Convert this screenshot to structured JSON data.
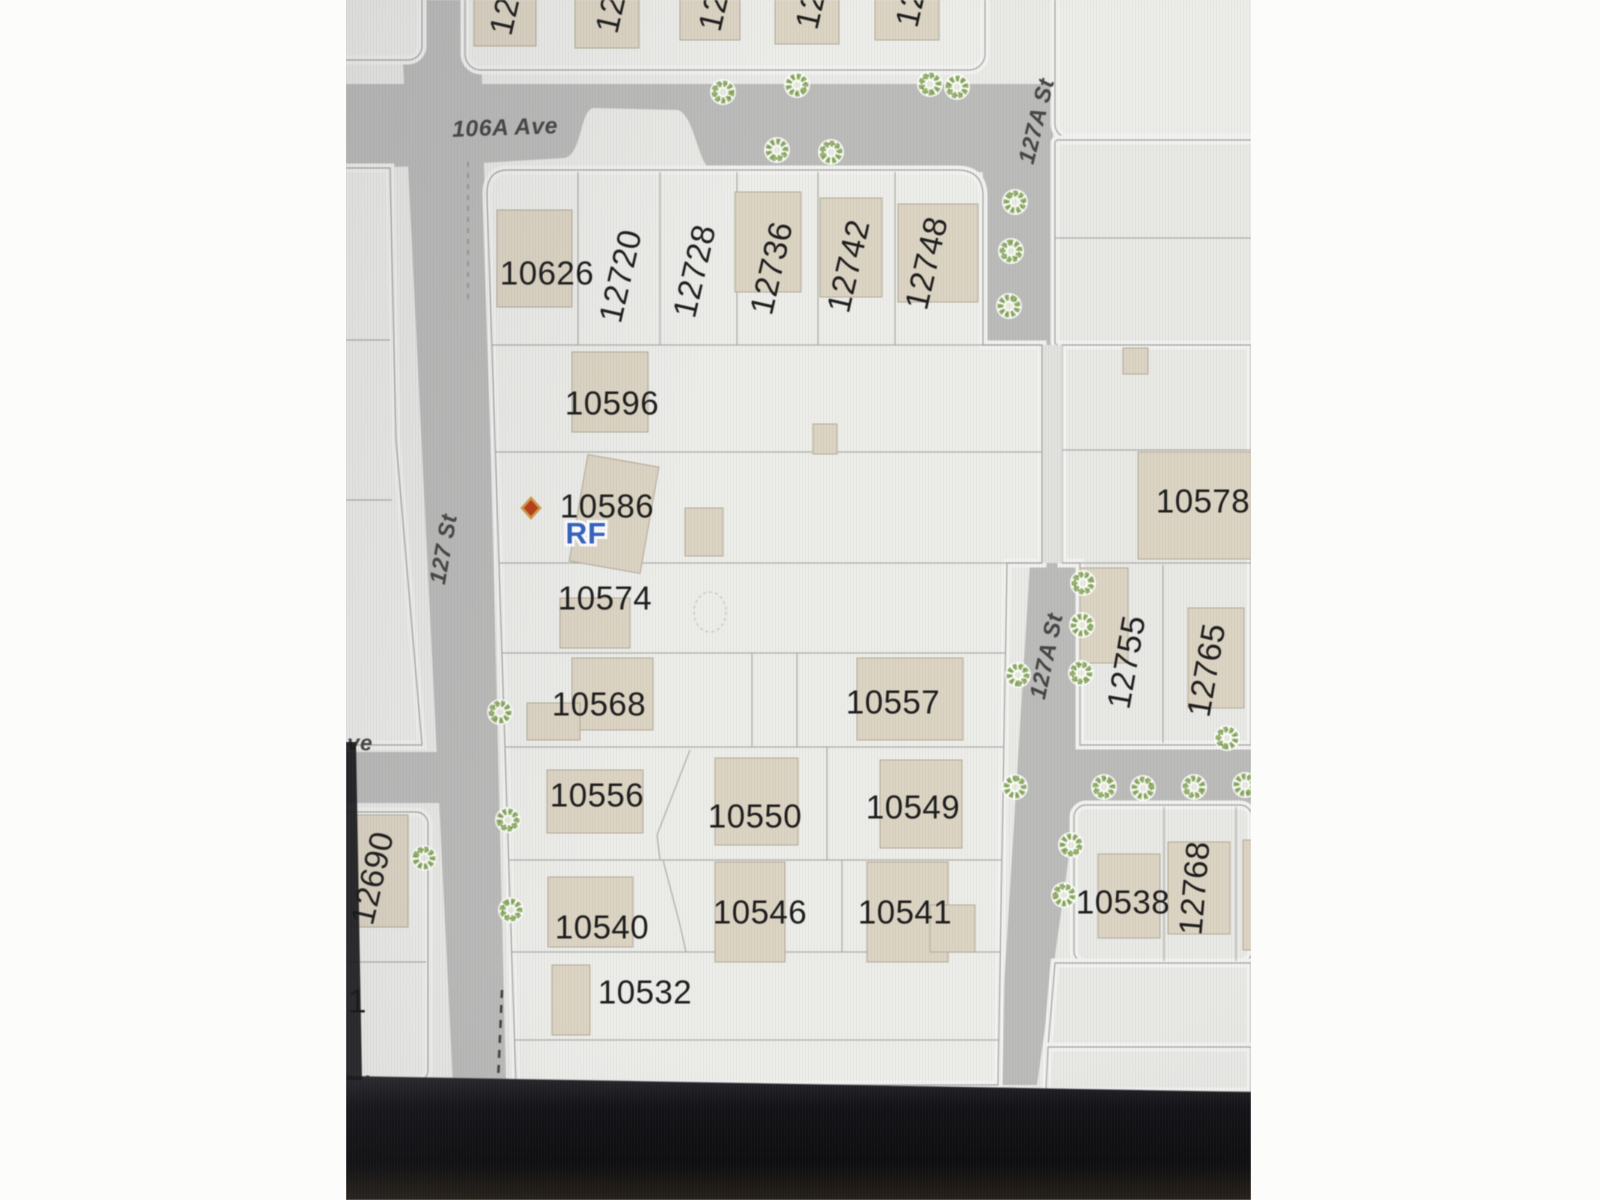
{
  "scene": {
    "description": "photo of a computer screen showing a cadastral parcel map",
    "bezel": {
      "top_left_y": 1076,
      "top_right_y": 1092,
      "left_strip": "M0,742 L10,742 L16,1080 L0,1080 Z"
    }
  },
  "colors": {
    "pillar": "#fcfcfb",
    "parcel": "#eaeae7",
    "block": "#ededea",
    "block_east": "#e9e9e6",
    "lane": "#e2e2df",
    "road": "#bcbcbb",
    "line": "#a7a7a5",
    "halo": "#f3f3f1",
    "building": "#ded5c2",
    "building_stroke": "#b7ae97",
    "label": "#1b1b1b",
    "street": "#454543",
    "tree_ring": "#93b264",
    "tree_dark": "#75974a",
    "tree_core": "#e7ecdb",
    "rf_blue": "#2e62c8",
    "marker_red": "#c23b10",
    "marker_halo": "#d79a43",
    "bezel_a": "#26262b",
    "bezel_b": "#121216",
    "bezel_c": "#0c0c0e",
    "bezel_d": "#241e16"
  },
  "map": {
    "streets": [
      {
        "label": "106A Ave",
        "x": 159,
        "y": 127,
        "rot": -2,
        "size": 23
      },
      {
        "label": "127 St",
        "x": 97,
        "y": 549,
        "rot": -80,
        "size": 23
      },
      {
        "label": "127A St",
        "x": 690,
        "y": 121,
        "rot": -76,
        "size": 23
      },
      {
        "label": "127A St",
        "x": 700,
        "y": 656,
        "rot": -78,
        "size": 23
      },
      {
        "label": "ve",
        "x": 14,
        "y": 743,
        "rot": 0,
        "size": 22
      }
    ],
    "lots": [
      {
        "label": "10626",
        "x": 201,
        "y": 273
      },
      {
        "label": "12720",
        "x": 274,
        "y": 276,
        "rot": -77
      },
      {
        "label": "12728",
        "x": 348,
        "y": 271,
        "rot": -77
      },
      {
        "label": "12736",
        "x": 425,
        "y": 268,
        "rot": -77
      },
      {
        "label": "12742",
        "x": 502,
        "y": 266,
        "rot": -77
      },
      {
        "label": "12748",
        "x": 580,
        "y": 263,
        "rot": -77
      },
      {
        "label": "10596",
        "x": 266,
        "y": 403
      },
      {
        "label": "10586",
        "x": 261,
        "y": 506
      },
      {
        "label": "10574",
        "x": 259,
        "y": 598
      },
      {
        "label": "10568",
        "x": 253,
        "y": 704
      },
      {
        "label": "10557",
        "x": 547,
        "y": 702
      },
      {
        "label": "10556",
        "x": 251,
        "y": 795
      },
      {
        "label": "10550",
        "x": 409,
        "y": 816
      },
      {
        "label": "10549",
        "x": 567,
        "y": 807
      },
      {
        "label": "10540",
        "x": 256,
        "y": 927
      },
      {
        "label": "10546",
        "x": 414,
        "y": 912
      },
      {
        "label": "10541",
        "x": 559,
        "y": 912
      },
      {
        "label": "10532",
        "x": 299,
        "y": 992
      },
      {
        "label": "10578",
        "x": 857,
        "y": 501
      },
      {
        "label": "10538",
        "x": 777,
        "y": 902
      },
      {
        "label": "12755",
        "x": 780,
        "y": 662,
        "rot": -80
      },
      {
        "label": "12765",
        "x": 860,
        "y": 670,
        "rot": -80
      },
      {
        "label": "12690",
        "x": 26,
        "y": 878,
        "rot": -77
      },
      {
        "label": "12768",
        "x": 848,
        "y": 888,
        "rot": -85
      }
    ],
    "partial_labels": [
      {
        "label": "12",
        "x": 158,
        "y": 16,
        "rot": -77
      },
      {
        "label": "12",
        "x": 264,
        "y": 14,
        "rot": -77
      },
      {
        "label": "12",
        "x": 367,
        "y": 12,
        "rot": -77
      },
      {
        "label": "12",
        "x": 464,
        "y": 10,
        "rot": -77
      },
      {
        "label": "12",
        "x": 564,
        "y": 8,
        "rot": -77
      },
      {
        "label": "51",
        "x": 2,
        "y": 1001,
        "rot": 0
      },
      {
        "label": "21",
        "x": 12,
        "y": 1087,
        "rot": 0
      }
    ],
    "subject": {
      "marker": {
        "x": 185,
        "y": 508,
        "w": 18,
        "h": 20
      },
      "rf": {
        "label": "RF",
        "x": 240,
        "y": 534,
        "size": 30
      }
    },
    "roads": [
      {
        "name": "106A Ave + 127A St upper",
        "d": "M0,84 L707,84 L707,345 L637,345 L637,172 L370,172 C352,172 350,116 332,110 L248,108 C234,108 236,156 218,158 L84,166 L0,168 Z"
      },
      {
        "name": "127 St",
        "d": "M54,0 L134,0 L160,1085 L107,1085 Z"
      },
      {
        "name": "127A St lower + east arm",
        "d": "M684,563 L734,563 L734,745 L905,745 L905,805 L730,805 L691,1085 L652,1085 Z"
      },
      {
        "name": "west avenue stub",
        "d": "M-5,752 L92,752 L96,803 L-5,803 Z"
      }
    ],
    "lane": {
      "x": 696,
      "y": 345,
      "w": 20,
      "h": 218
    },
    "blocks": [
      {
        "r": [
          -30,
          -30,
          106,
          90,
          14
        ]
      },
      {
        "r": [
          119,
          -62,
          520,
          132,
          16
        ]
      },
      {
        "r": [
          709,
          -30,
          244,
          168,
          14
        ]
      },
      {
        "r": [
          709,
          140,
          244,
          205,
          3
        ],
        "east": true
      },
      {
        "d": "M716,345 L905,345 L905,745 L734,745 L734,563 L716,563 Z",
        "east": true
      },
      {
        "r": [
          728,
          805,
          178,
          158,
          12
        ],
        "east": true
      },
      {
        "d": "M709,963 L905,963 L905,1047 L702,1047 Z",
        "east": true
      },
      {
        "d": "M702,1047 L905,1047 L905,1092 L700,1092 Z",
        "east": true
      },
      {
        "d": "M-30,168 L44,168 L50,440 L76,745 L-30,745 Z"
      },
      {
        "r": [
          -30,
          812,
          112,
          270,
          12
        ]
      },
      {
        "d": "M162,170 L611,170 Q637,170 637,196 L637,345 L696,345 L696,563 L661,563 L652,1085 L170,1085 L141,196 Q140,170 162,170 Z",
        "main": true
      }
    ],
    "lines": [
      [
        146,
        345,
        696,
        345
      ],
      [
        149,
        452,
        696,
        452
      ],
      [
        153,
        563,
        696,
        563
      ],
      [
        156,
        653,
        659,
        653
      ],
      [
        159,
        747,
        658,
        747
      ],
      [
        163,
        860,
        656,
        860
      ],
      [
        166,
        952,
        655,
        952
      ],
      [
        169,
        1040,
        653,
        1040
      ],
      [
        232,
        172,
        232,
        345
      ],
      [
        314,
        172,
        314,
        345
      ],
      [
        391,
        172,
        391,
        345
      ],
      [
        472,
        172,
        472,
        345
      ],
      [
        549,
        172,
        549,
        345
      ],
      [
        406,
        653,
        406,
        747
      ],
      [
        451,
        653,
        451,
        747
      ],
      [
        344,
        750,
        311,
        835
      ],
      [
        311,
        835,
        314,
        860
      ],
      [
        481,
        747,
        481,
        860
      ],
      [
        317,
        860,
        334,
        925
      ],
      [
        334,
        925,
        340,
        952
      ],
      [
        496,
        860,
        496,
        952
      ],
      [
        696,
        345,
        696,
        563
      ],
      [
        709,
        238,
        905,
        238
      ],
      [
        716,
        450,
        905,
        450
      ],
      [
        734,
        563,
        905,
        563
      ],
      [
        817,
        565,
        817,
        743
      ],
      [
        818,
        807,
        818,
        961
      ],
      [
        890,
        807,
        890,
        961
      ],
      [
        0,
        340,
        44,
        340
      ],
      [
        0,
        500,
        46,
        500
      ],
      [
        -10,
        962,
        80,
        962
      ]
    ],
    "dashed_lines": [
      {
        "x1": 122,
        "y1": 162,
        "x2": 122,
        "y2": 300,
        "dash": "5 6",
        "c": "#8f8f8d",
        "w": 1.5
      },
      {
        "x1": 156,
        "y1": 990,
        "x2": 152,
        "y2": 1082,
        "dash": "8 7",
        "c": "#3f3f41",
        "w": 2.5
      }
    ],
    "dashed_circle": {
      "cx": 364,
      "cy": 612,
      "rx": 16,
      "ry": 20
    },
    "buildings": [
      [
        128,
        -8,
        62,
        54
      ],
      [
        229,
        -8,
        64,
        56
      ],
      [
        334,
        -8,
        60,
        48
      ],
      [
        429,
        -8,
        64,
        52
      ],
      [
        529,
        -8,
        64,
        48
      ],
      [
        151,
        210,
        75,
        97
      ],
      [
        389,
        192,
        66,
        100
      ],
      [
        474,
        198,
        62,
        99
      ],
      [
        552,
        204,
        80,
        98
      ],
      [
        226,
        352,
        76,
        80
      ],
      {
        "x": 232,
        "y": 460,
        "w": 72,
        "h": 108,
        "rot": 10
      },
      [
        339,
        508,
        38,
        48
      ],
      [
        467,
        424,
        24,
        30
      ],
      [
        777,
        348,
        25,
        26
      ],
      [
        214,
        598,
        70,
        50
      ],
      [
        226,
        658,
        81,
        72
      ],
      [
        181,
        703,
        53,
        37
      ],
      [
        511,
        658,
        106,
        82
      ],
      [
        201,
        770,
        96,
        63
      ],
      [
        369,
        758,
        83,
        87
      ],
      [
        534,
        760,
        82,
        88
      ],
      [
        202,
        877,
        85,
        70
      ],
      [
        369,
        862,
        70,
        100
      ],
      [
        521,
        862,
        81,
        100
      ],
      [
        584,
        905,
        45,
        47
      ],
      [
        206,
        965,
        38,
        70
      ],
      [
        792,
        452,
        113,
        107
      ],
      [
        734,
        568,
        48,
        95
      ],
      [
        842,
        608,
        56,
        100
      ],
      [
        6,
        815,
        56,
        112
      ],
      [
        752,
        854,
        62,
        84
      ],
      [
        822,
        842,
        62,
        92
      ],
      [
        897,
        840,
        20,
        110
      ]
    ],
    "trees": [
      [
        377,
        92
      ],
      [
        451,
        85
      ],
      [
        584,
        84
      ],
      [
        431,
        150
      ],
      [
        485,
        152
      ],
      [
        611,
        87
      ],
      [
        669,
        202
      ],
      [
        665,
        251
      ],
      [
        663,
        306
      ],
      [
        737,
        583
      ],
      [
        736,
        625
      ],
      [
        735,
        673
      ],
      [
        672,
        675
      ],
      [
        154,
        712
      ],
      [
        162,
        820
      ],
      [
        78,
        858
      ],
      [
        165,
        910
      ],
      [
        669,
        787
      ],
      [
        758,
        787
      ],
      [
        797,
        788
      ],
      [
        848,
        787
      ],
      [
        899,
        785
      ],
      [
        881,
        738
      ],
      [
        725,
        845
      ],
      [
        718,
        895
      ]
    ]
  }
}
